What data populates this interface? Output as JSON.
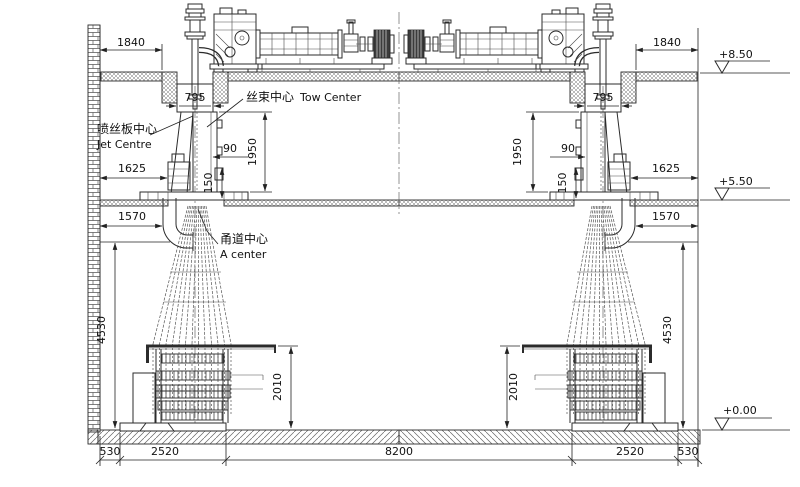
{
  "drawing": {
    "labels": {
      "tow_zh": "丝束中心",
      "tow_en": "Tow Center",
      "jet_zh": "喷丝板中心",
      "jet_en": "Jet Centre",
      "duct_zh": "甬道中心",
      "duct_en": "A center"
    },
    "levels": {
      "roof": "+8.50",
      "mid": "+5.50",
      "ground": "+0.00"
    },
    "dims": {
      "wall_to_beam": "1840",
      "opening": "795",
      "jet_offset": "90",
      "beam_height": "1950",
      "platform": "150",
      "pump_offset": "1625",
      "duct_offset": "1570",
      "hall_height": "4530",
      "machine_height": "2010",
      "edge": "530",
      "machine_width": "2520",
      "center_span": "8200"
    }
  }
}
